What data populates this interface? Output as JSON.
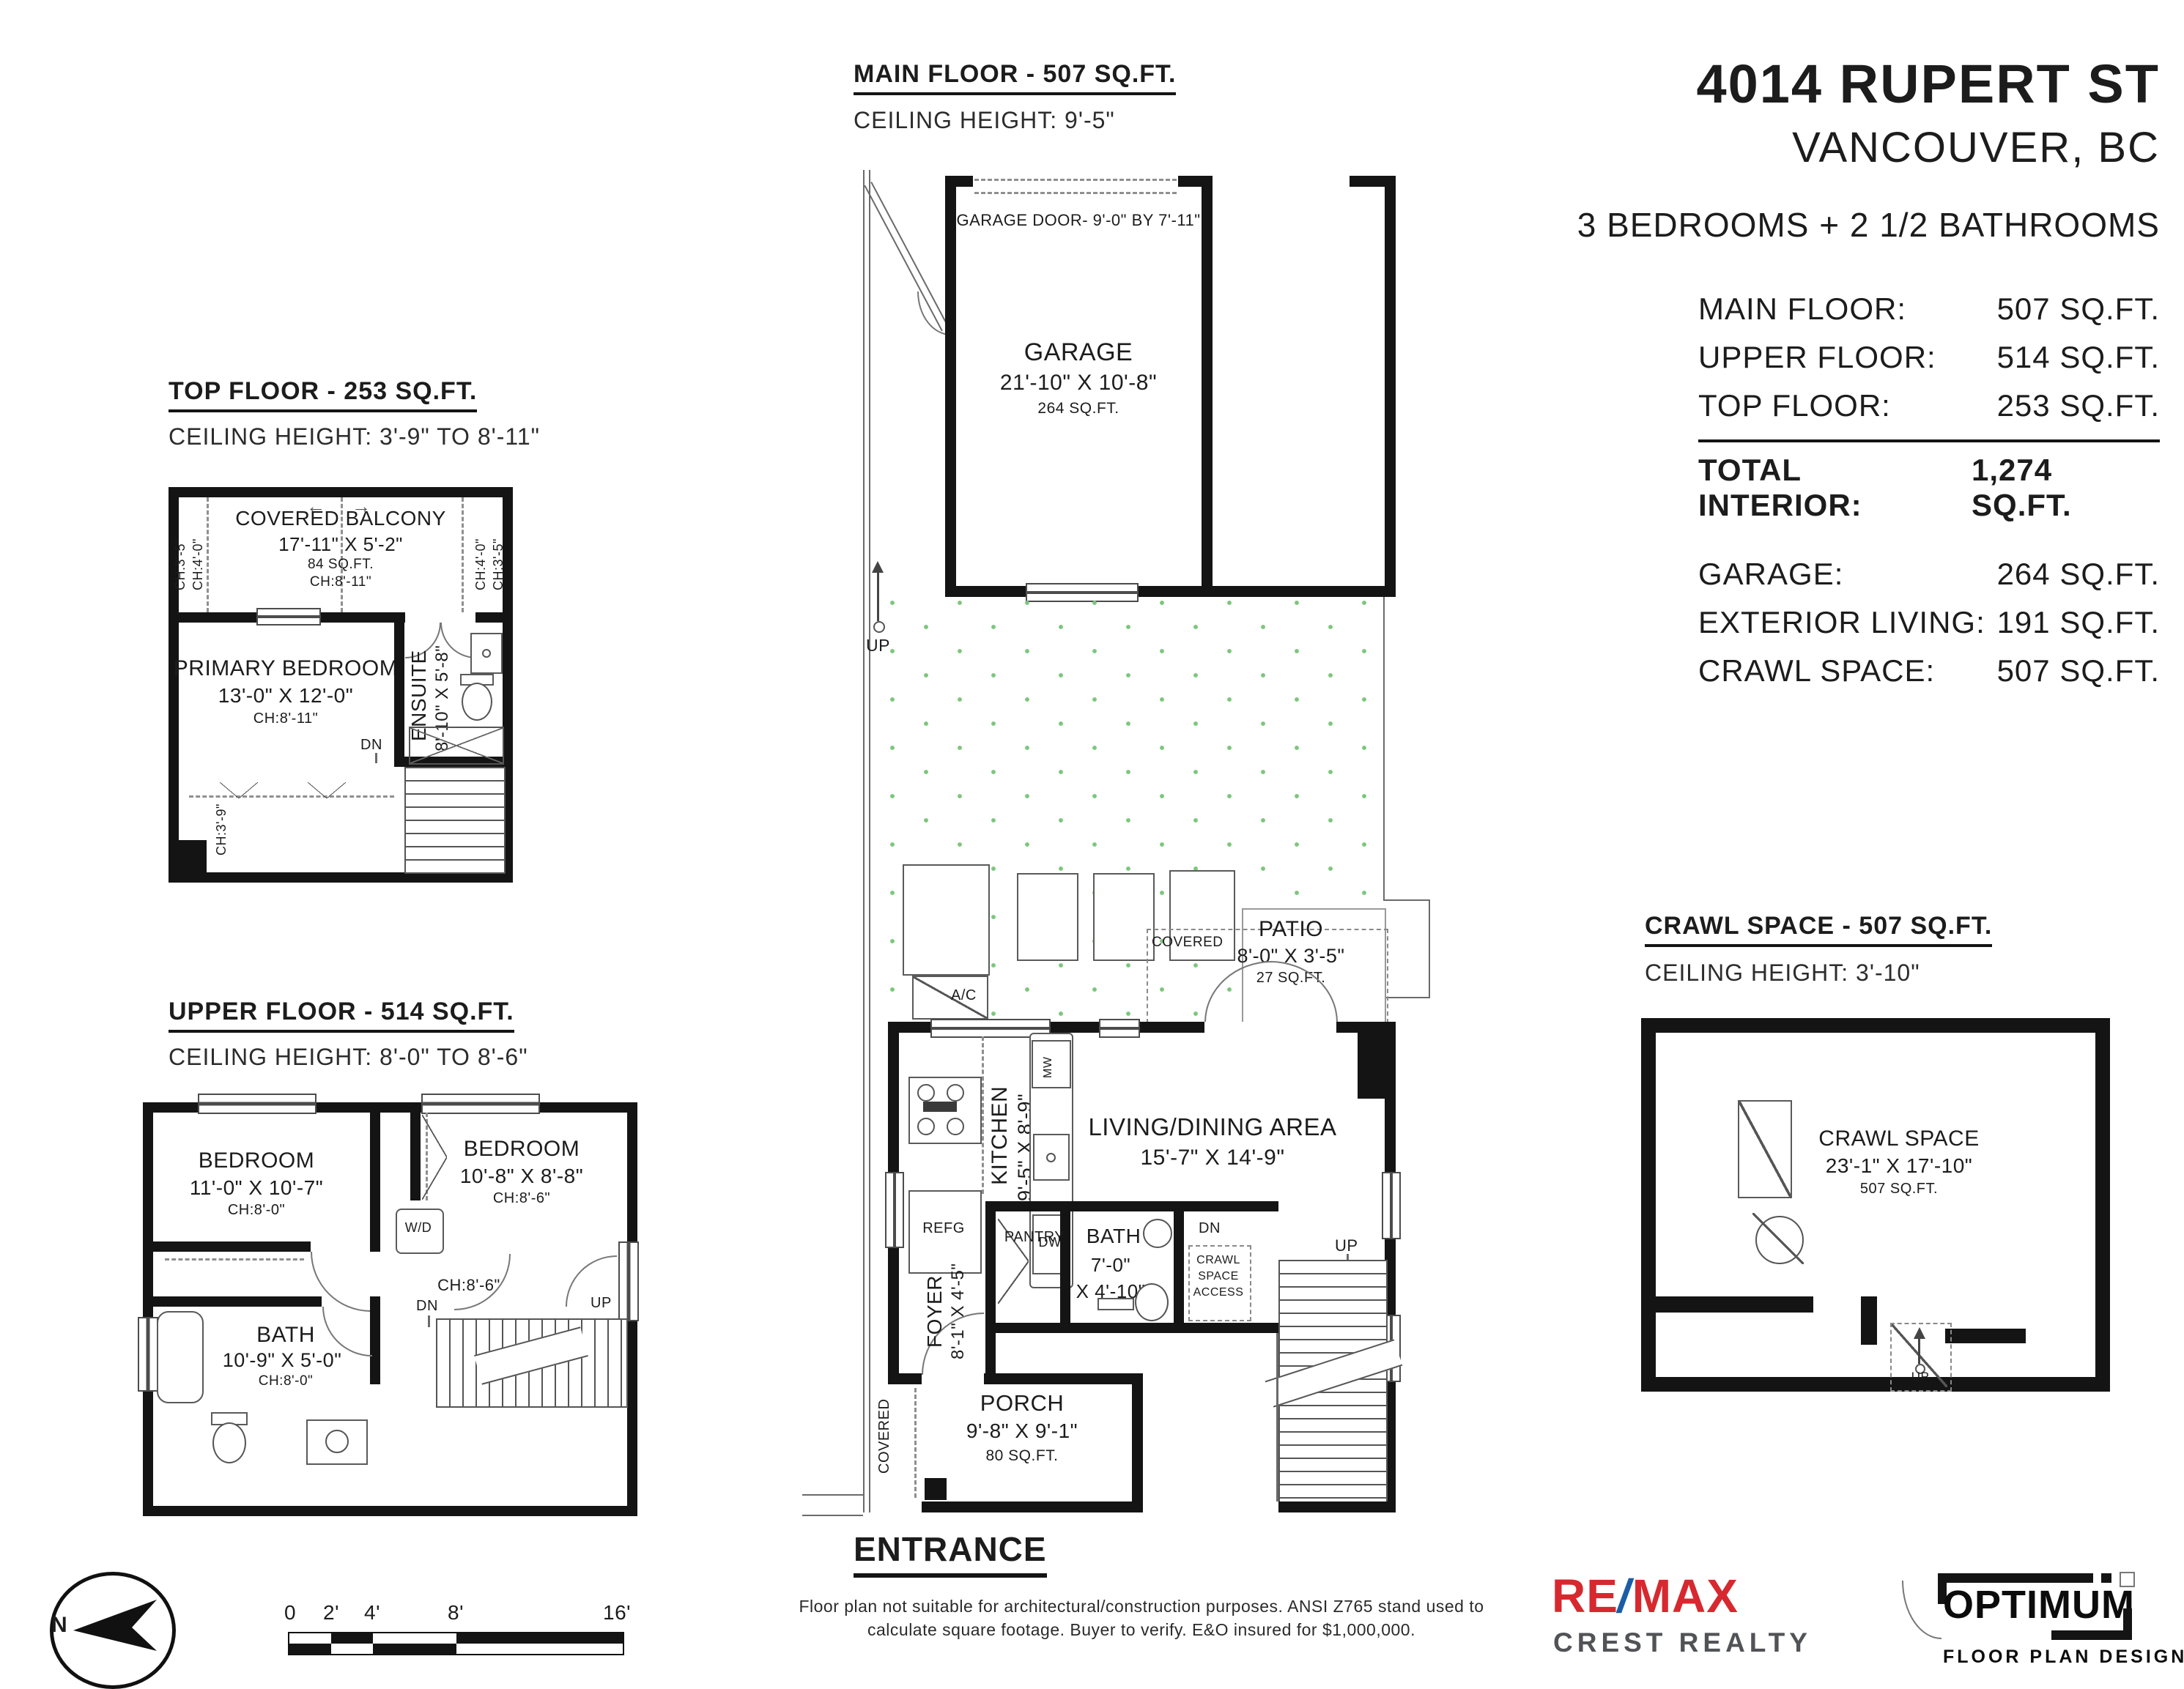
{
  "header": {
    "address": "4014 RUPERT ST",
    "city": "VANCOUVER, BC",
    "summary": "3 BEDROOMS + 2 1/2 BATHROOMS",
    "table": {
      "rows": [
        {
          "label": "MAIN FLOOR:",
          "value": "507 SQ.FT."
        },
        {
          "label": "UPPER FLOOR:",
          "value": "514 SQ.FT."
        },
        {
          "label": "TOP FLOOR:",
          "value": "253 SQ.FT."
        },
        {
          "label": "TOTAL INTERIOR:",
          "value": "1,274 SQ.FT."
        }
      ],
      "rows2": [
        {
          "label": "GARAGE:",
          "value": "264 SQ.FT."
        },
        {
          "label": "EXTERIOR LIVING:",
          "value": "191 SQ.FT."
        },
        {
          "label": "CRAWL SPACE:",
          "value": "507 SQ.FT."
        }
      ]
    }
  },
  "plans": {
    "top_floor": {
      "title": "TOP FLOOR - 253 SQ.FT.",
      "ceiling": "CEILING HEIGHT: 3'-9\" TO 8'-11\"",
      "balcony": {
        "name": "COVERED BALCONY",
        "dims": "17'-11\" X 5'-2\"",
        "area": "84 SQ.FT.",
        "ch": "CH:8'-11\""
      },
      "bedroom": {
        "name": "PRIMARY BEDROOM",
        "dims": "13'-0\" X 12'-0\"",
        "ch": "CH:8'-11\""
      },
      "ensuite": {
        "name": "ENSUITE",
        "dims": "8'-10\" X 5'-8\""
      },
      "labels": {
        "dn": "DN",
        "ch_left_outer": "CH:3'-5\"",
        "ch_left_inner": "CH:4'-0\"",
        "ch_right_inner": "CH:4'-0\"",
        "ch_right_outer": "CH:3'-5\"",
        "ch_knee": "CH:3'-9\"",
        "arrow_left": "←",
        "arrow_right": "→"
      }
    },
    "upper_floor": {
      "title": "UPPER FLOOR - 514 SQ.FT.",
      "ceiling": "CEILING HEIGHT: 8'-0\" TO 8'-6\"",
      "bedroom1": {
        "name": "BEDROOM",
        "dims": "11'-0\" X 10'-7\"",
        "ch": "CH:8'-0\""
      },
      "bedroom2": {
        "name": "BEDROOM",
        "dims": "10'-8\" X 8'-8\"",
        "ch": "CH:8'-6\""
      },
      "bath": {
        "name": "BATH",
        "dims": "10'-9\" X 5'-0\"",
        "ch": "CH:8'-0\""
      },
      "labels": {
        "wd": "W/D",
        "hall_ch": "CH:8'-6\"",
        "dn": "DN",
        "up": "UP"
      }
    },
    "main_floor": {
      "title": "MAIN FLOOR - 507 SQ.FT.",
      "ceiling": "CEILING HEIGHT: 9'-5\"",
      "garage": {
        "name": "GARAGE",
        "dims": "21'-10\" X 10'-8\"",
        "area": "264 SQ.FT.",
        "door": "GARAGE DOOR- 9'-0\" BY 7'-11\""
      },
      "patio": {
        "name": "PATIO",
        "dims": "8'-0\" X 3'-5\"",
        "area": "27 SQ.FT.",
        "covered": "COVERED"
      },
      "kitchen": {
        "name": "KITCHEN",
        "dims": "9'-5\" X 8'-9\""
      },
      "living": {
        "name": "LIVING/DINING AREA",
        "dims": "15'-7\" X 14'-9\""
      },
      "foyer": {
        "name": "FOYER",
        "dims": "8'-1\" X 4'-5\""
      },
      "bath": {
        "name": "BATH",
        "dims1": "7'-0\"",
        "dims2": "X 4'-10\""
      },
      "porch": {
        "name": "PORCH",
        "dims": "9'-8\" X 9'-1\"",
        "area": "80 SQ.FT.",
        "covered": "COVERED"
      },
      "labels": {
        "up_yard": "UP",
        "up_stairs": "UP",
        "dn": "DN",
        "mw": "MW",
        "dw": "DW",
        "refg": "REFG",
        "ac": "A/C",
        "pantry": "PANTRY",
        "crawl1": "CRAWL",
        "crawl2": "SPACE",
        "crawl3": "ACCESS",
        "entrance": "ENTRANCE"
      }
    },
    "crawl_space": {
      "title": "CRAWL SPACE - 507 SQ.FT.",
      "ceiling": "CEILING HEIGHT: 3'-10\"",
      "room": {
        "name": "CRAWL SPACE",
        "dims": "23'-1\" X 17'-10\"",
        "area": "507 SQ.FT."
      },
      "labels": {
        "up": "UP"
      }
    }
  },
  "footer": {
    "north": "N",
    "scale_ticks": [
      "0",
      "2'",
      "4'",
      "8'",
      "16'"
    ],
    "disclaimer1": "Floor plan not suitable for architectural/construction purposes. ANSI Z765 stand used to",
    "disclaimer2": "calculate square footage. Buyer to verify.  E&O insured for $1,000,000."
  },
  "logos": {
    "remax_re": "RE",
    "remax_slash": "/",
    "remax_max": "MAX",
    "remax_sub": "CREST REALTY",
    "optimum": "OPTIMUM",
    "optimum_sub": "FLOOR PLAN DESIGNS"
  },
  "colors": {
    "remax_red": "#d7282f",
    "remax_blue": "#1a5da6",
    "grass_green": "#7cc67c",
    "ink": "#141414"
  }
}
